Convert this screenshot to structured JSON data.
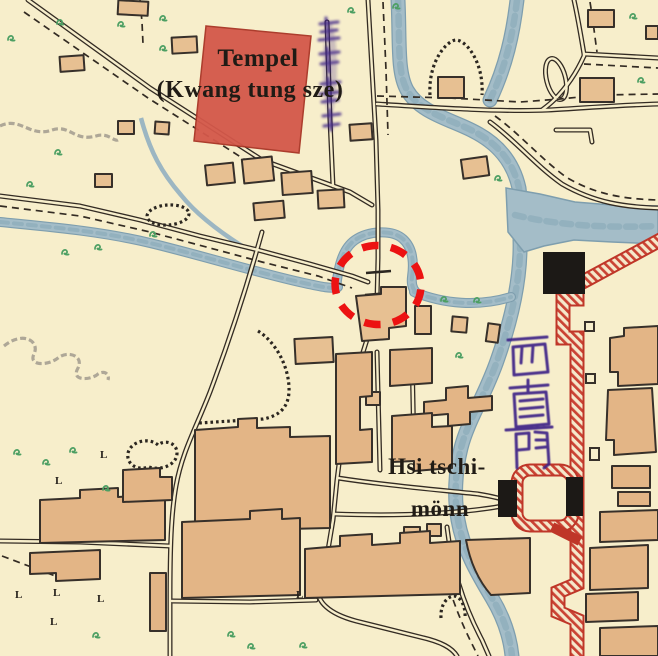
{
  "labels": {
    "temple_line1": "Tempel",
    "temple_line2": "(Kwang tung sze)",
    "gate_line1": "Hsi tschi-",
    "gate_line2": "mönn"
  },
  "hanzi": {
    "gate_vertical_text": "西直門",
    "gate_romanization": "Hsi tschi-mönn",
    "temple_margin_note": "illegible purple handwriting (vertical)"
  },
  "symbols": {
    "l_mark": "L",
    "grass_mark": "grass-tuft",
    "mound_mark": "horseshoe-hachure",
    "pond_mark": "dotted-outline"
  },
  "annotation": {
    "type": "dashed-circle",
    "color": "#ec1212"
  },
  "colors": {
    "paper": "#f7eecb",
    "building_fill": "#e7c092",
    "building_fill_dark": "#e3b586",
    "outline_ink": "#37302a",
    "water": "#a4bdc8",
    "wall_red": "#bf3628",
    "wall_hatch": "#ca4334",
    "temple_red": "#d4584a",
    "hanzi_purple": "#3e2487",
    "grass_green": "#4d9f63",
    "annotation_red": "#ec1212"
  }
}
